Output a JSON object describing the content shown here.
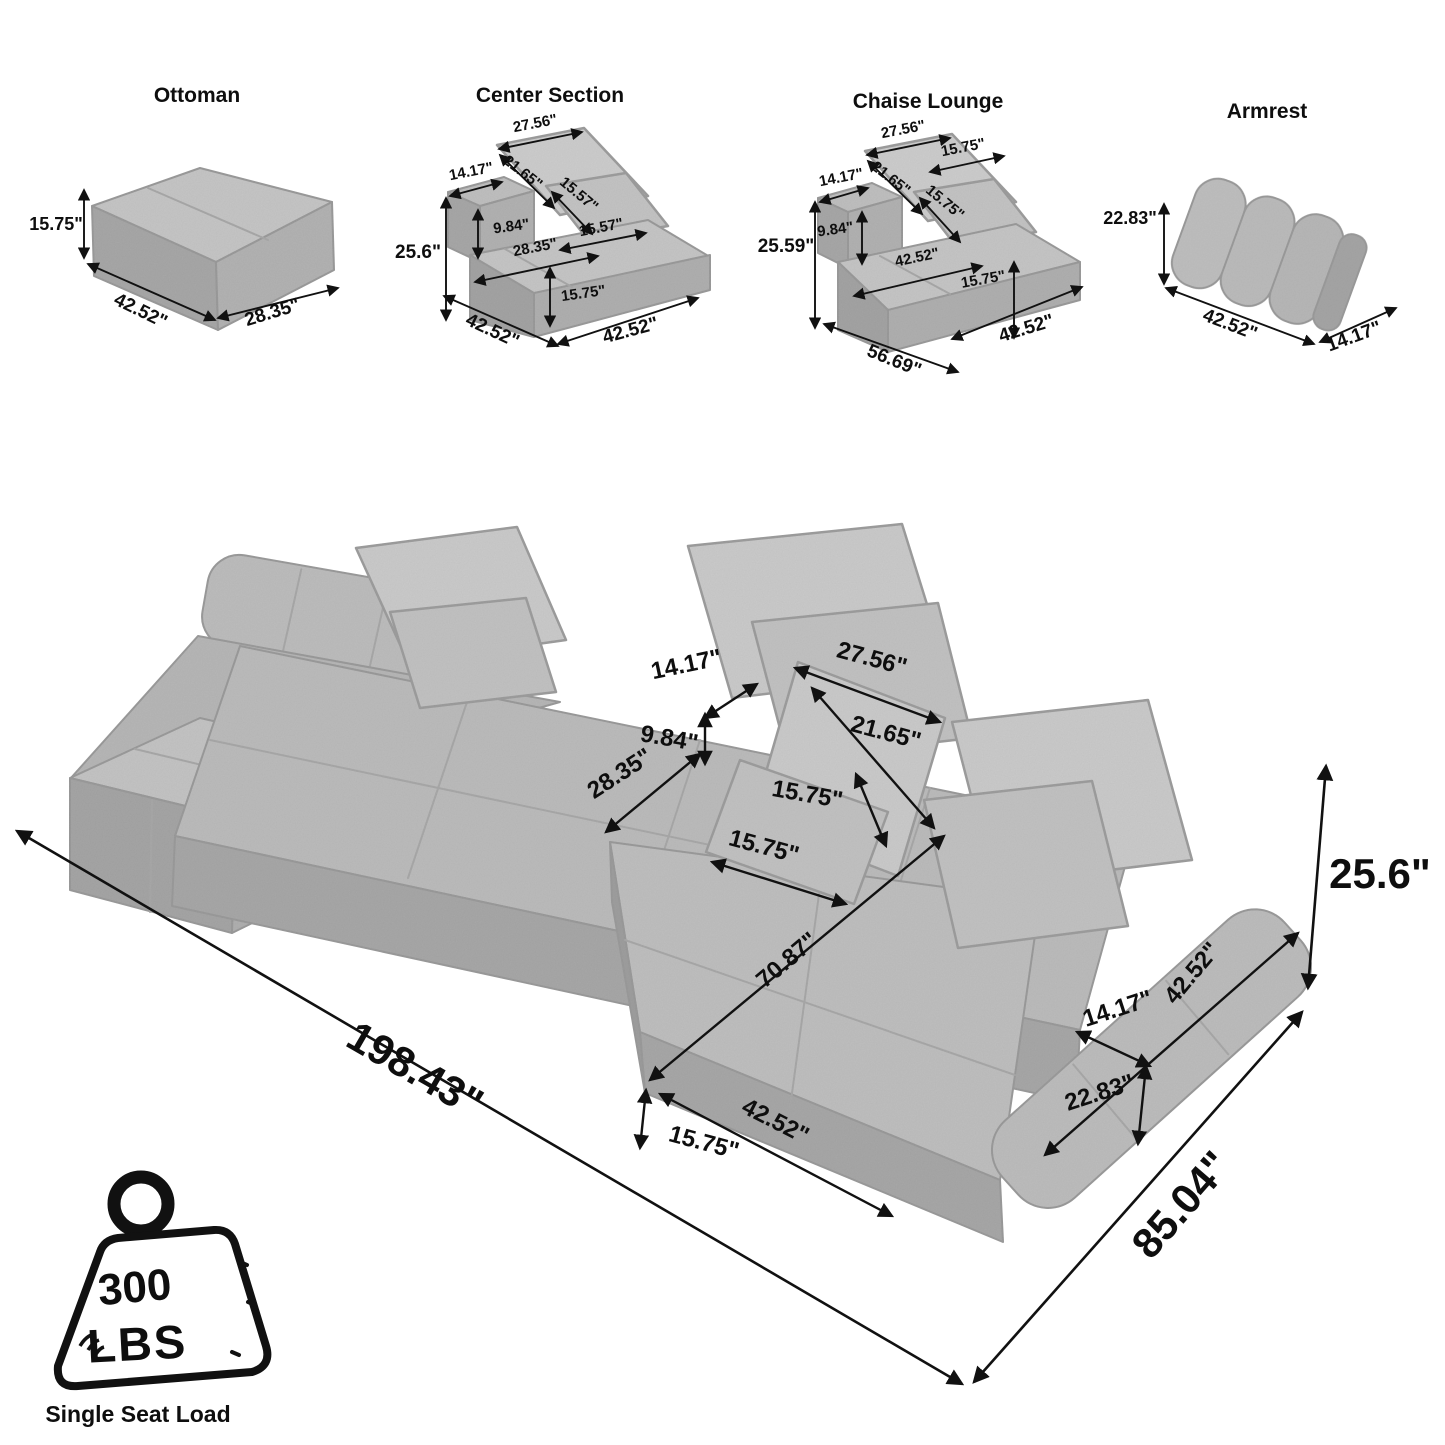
{
  "colors": {
    "background": "#ffffff",
    "sofa_light": "#c6c6c6",
    "sofa_mid": "#b4b4b4",
    "sofa_dark": "#a4a4a4",
    "pillow": "#cbcbcb",
    "line": "#111111"
  },
  "components": {
    "ottoman": {
      "title": "Ottoman",
      "labels": {
        "height": "15.75\"",
        "width": "42.52\"",
        "depth": "28.35\""
      }
    },
    "center_section": {
      "title": "Center Section",
      "labels": {
        "pillow_top": "27.56\"",
        "pillow_diag": "21.65\"",
        "back_depth": "14.17\"",
        "pillow_small_h": "15.57\"",
        "back_rise": "9.84\"",
        "pillow_small_w": "15.57\"",
        "height": "25.6\"",
        "seat_depth": "28.35\"",
        "seat_height": "15.75\"",
        "width_left": "42.52\"",
        "width_right": "42.52\""
      }
    },
    "chaise_lounge": {
      "title": "Chaise Lounge",
      "labels": {
        "pillow_top": "27.56\"",
        "pillow_diag": "21.65\"",
        "pillow_small_top": "15.75\"",
        "back_depth": "14.17\"",
        "pillow_small_h": "15.75\"",
        "back_rise": "9.84\"",
        "height": "25.59\"",
        "seat_depth": "42.52\"",
        "seat_height": "15.75\"",
        "length": "56.69\"",
        "width": "42.52\""
      }
    },
    "armrest": {
      "title": "Armrest",
      "labels": {
        "height": "22.83\"",
        "length": "42.52\"",
        "depth": "14.17\""
      }
    }
  },
  "main": {
    "labels": {
      "back_depth": "14.17\"",
      "pillow_top": "27.56\"",
      "pillow_diag": "21.65\"",
      "back_rise": "9.84\"",
      "pillow_h": "15.75\"",
      "seat_depth": "28.35\"",
      "pillow_w": "15.75\"",
      "chaise_length": "70.87\"",
      "armrest_length": "42.52\"",
      "armrest_depth": "14.17\"",
      "armrest_height": "22.83\"",
      "front_width": "42.52\"",
      "seat_height": "15.75\"",
      "total_length": "198.43\"",
      "total_depth": "85.04\"",
      "total_height": "25.6\""
    }
  },
  "load_badge": {
    "value": "300",
    "unit": "LBS",
    "caption": "Single Seat Load"
  }
}
